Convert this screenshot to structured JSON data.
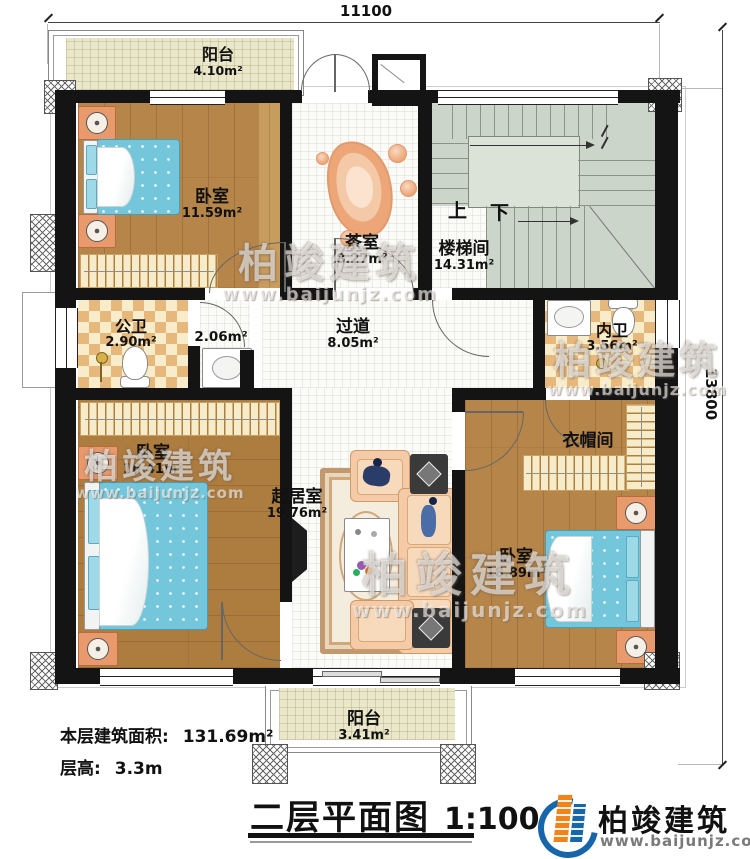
{
  "watermark": {
    "brand": "柏竣建筑",
    "site": "www.baijunjz.com"
  },
  "dims": {
    "top": "11100",
    "right": "13800"
  },
  "stairs": {
    "up": "上",
    "down": "下"
  },
  "rooms": {
    "balcony_top": {
      "name": "阳台",
      "area": "4.10m²"
    },
    "bedroom_top": {
      "name": "卧室",
      "area": "11.59m²"
    },
    "tea_room": {
      "name": "茶室",
      "area": "8.27m²"
    },
    "stairwell": {
      "name": "楼梯间",
      "area": "14.31m²"
    },
    "public_bath": {
      "name": "公卫",
      "area": "2.90m²"
    },
    "wash_nook": {
      "area": "2.06m²"
    },
    "hallway": {
      "name": "过道",
      "area": "8.05m²"
    },
    "ensuite_bath": {
      "name": "内卫",
      "area": "3.56m²"
    },
    "bedroom_left": {
      "name": "卧室",
      "area": "16.41m²"
    },
    "living_room": {
      "name": "起居室",
      "area": "19.76m²"
    },
    "cloakroom": {
      "name": "衣帽间"
    },
    "bedroom_right": {
      "name": "卧室",
      "area": "18.89m²"
    },
    "balcony_bottom": {
      "name": "阳台",
      "area": "3.41m²"
    }
  },
  "footer": {
    "area_label": "本层建筑面积:",
    "area_value": "131.69m²",
    "height_label": "层高:",
    "height_value": "3.3m",
    "title": "二层平面图",
    "scale": "1:100"
  },
  "logo": {
    "brand": "柏竣建筑",
    "site": "www.baijunjz.com"
  },
  "colors": {
    "wall": "#141414",
    "wood": "#b5854a",
    "bath_tile": "#e6b87c",
    "stair_floor": "#cbd5ca",
    "balcony_floor": "#ebe7cb",
    "bed_blue": "#74c6db",
    "sofa_peach": "#f4cba6",
    "logo_blue": "#1766ab",
    "logo_orange": "#f08418"
  }
}
